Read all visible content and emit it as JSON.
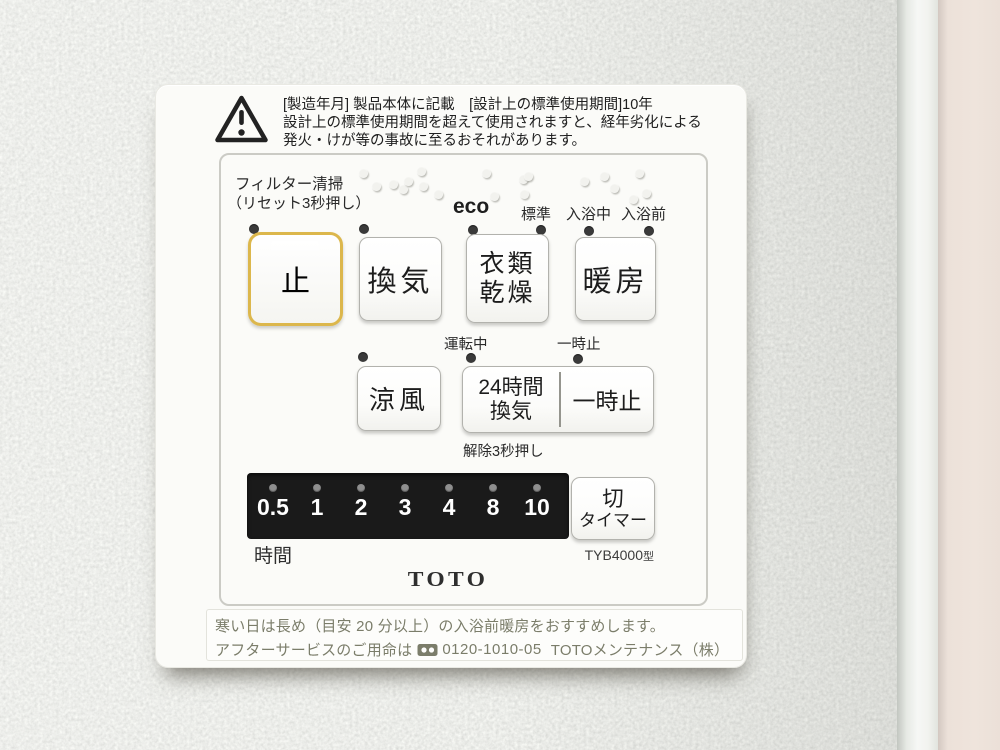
{
  "device": {
    "brand_logo": "TOTO",
    "model": "TYB4000",
    "model_suffix": "型"
  },
  "warning": {
    "line1": "[製造年月] 製品本体に記載　[設計上の標準使用期間]10年",
    "line2": "設計上の標準使用期間を超えて使用されますと、経年劣化による",
    "line3": "発火・けが等の事故に至るおそれがあります。"
  },
  "filter": {
    "title": "フィルター清掃",
    "subtitle": "（リセット3秒押し）"
  },
  "modes": {
    "eco": "eco",
    "standard": "標準",
    "in_bath": "入浴中",
    "pre_bath": "入浴前"
  },
  "buttons": {
    "stop": "止",
    "ventilation": "換気",
    "clothes_dry": "衣類\n乾燥",
    "heating": "暖房",
    "cool_breeze": "涼風",
    "vent24h": "24時間\n換気",
    "pause": "一時止",
    "off_timer_line1": "切",
    "off_timer_line2": "タイマー"
  },
  "row2_labels": {
    "running": "運転中",
    "pause": "一時止",
    "release": "解除3秒押し"
  },
  "timer": {
    "values": [
      "0.5",
      "1",
      "2",
      "3",
      "4",
      "8",
      "10"
    ],
    "unit": "時間"
  },
  "footer": {
    "line1": "寒い日は長め（目安 20 分以上）の入浴前暖房をおすすめします。",
    "line2_prefix": "アフターサービスのご用命は",
    "phone": "0120-1010-05",
    "line2_suffix": "TOTOメンテナンス（株）"
  },
  "colors": {
    "stop_frame_yellow": "#dcb74c",
    "led_dark": "#3a3a3a",
    "timer_strip_black": "#1a1a1a",
    "footer_olive": "#7b7d6a"
  },
  "decor": {
    "braille_dots": [
      [
        207,
        88
      ],
      [
        220,
        101
      ],
      [
        237,
        99
      ],
      [
        247,
        104
      ],
      [
        252,
        96
      ],
      [
        265,
        86
      ],
      [
        267,
        101
      ],
      [
        282,
        109
      ],
      [
        330,
        88
      ],
      [
        338,
        111
      ],
      [
        367,
        94
      ],
      [
        372,
        91
      ],
      [
        368,
        109
      ],
      [
        428,
        96
      ],
      [
        448,
        91
      ],
      [
        458,
        103
      ],
      [
        477,
        114
      ],
      [
        483,
        88
      ],
      [
        490,
        108
      ]
    ]
  }
}
